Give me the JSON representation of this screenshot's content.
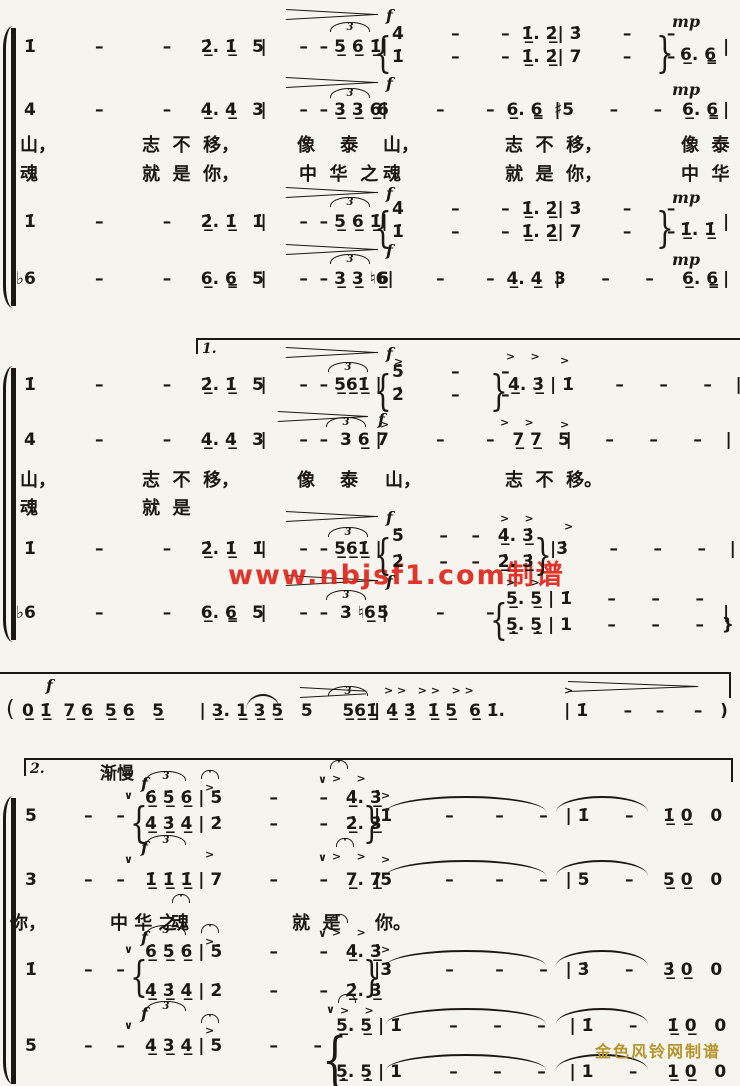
{
  "colors": {
    "paper": "#f6f4ee",
    "ink": "#1b1713",
    "watermark_red": "#e0241a",
    "watermark_gold": "#b5952c"
  },
  "watermark_red": {
    "text": "www.nbjsf1.com制谱"
  },
  "watermark_gold": {
    "text": "金色风铃网制谱"
  },
  "volta_labels": {
    "first": "1.",
    "second": "2."
  },
  "tempo_mark": "渐慢",
  "lyrics_lines": [
    "山， 志不移， 像泰山， 志不移， 像泰",
    "魂 就是你， 中华之魂 就是你， 中华",
    "山， 志不移， 像泰山， 志不移。",
    "魂 就是",
    "你， 中华之魂 就是你。"
  ],
  "segments": [
    {
      "n": "s1-sop-m1",
      "x": 24,
      "y": 37,
      "t": "1̇          –          –     2̲̇. 1̲̇    |"
    },
    {
      "n": "s1-sop-m2",
      "x": 252,
      "y": 37,
      "t": "5      –  – 5̲ 6̲ 1̲̇|"
    },
    {
      "n": "s1-sop-divisi-brace",
      "x": 374,
      "y": 28,
      "cls": "br",
      "t": "{"
    },
    {
      "n": "s1-sop-divisi-top",
      "x": 392,
      "y": 24,
      "t": "4̇        –       –  1̲̇. 2̲̇| 3̇       –      –"
    },
    {
      "n": "s1-sop-divisi-bottom",
      "x": 392,
      "y": 47,
      "t": "1̇        –       –  1̲̇. 2̲̇| 7       –      –"
    },
    {
      "n": "s1-sop-divisi-close",
      "x": 656,
      "y": 28,
      "cls": "br",
      "t": "}"
    },
    {
      "n": "s1-sop-m4-end",
      "x": 680,
      "y": 45,
      "t": "6̲. 6̳"
    },
    {
      "n": "s1-sop-barline-end",
      "x": 723,
      "y": 37,
      "t": "|"
    },
    {
      "n": "s1-alto-m1",
      "x": 24,
      "y": 100,
      "t": "4          –          –     4̲. 4̲    |"
    },
    {
      "n": "s1-alto-m2",
      "x": 252,
      "y": 100,
      "t": "3      –  – 3̲ 3̲ 6̲|"
    },
    {
      "n": "s1-alto-m3",
      "x": 377,
      "y": 100,
      "t": "6        –       –  6̲. 6̳  |"
    },
    {
      "n": "s1-alto-m4",
      "x": 554,
      "y": 100,
      "t": "♯5      –      –"
    },
    {
      "n": "s1-alto-m4-end",
      "x": 682,
      "y": 100,
      "t": "6̲. 6̳"
    },
    {
      "n": "s1-alto-barline-end",
      "x": 723,
      "y": 100,
      "t": "|"
    },
    {
      "n": "s1-lyric1-1",
      "cls": "lyr",
      "x": 20,
      "y": 131,
      "t": "山，"
    },
    {
      "n": "s1-lyric1-2",
      "cls": "lyr",
      "x": 142,
      "y": 131,
      "t": "志  不  移，"
    },
    {
      "n": "s1-lyric1-3",
      "cls": "lyr",
      "x": 297,
      "y": 131,
      "t": "像    泰"
    },
    {
      "n": "s1-lyric1-4",
      "cls": "lyr",
      "x": 383,
      "y": 131,
      "t": "山，"
    },
    {
      "n": "s1-lyric1-5",
      "cls": "lyr",
      "x": 505,
      "y": 131,
      "t": "志  不  移，"
    },
    {
      "n": "s1-lyric1-6",
      "cls": "lyr",
      "x": 681,
      "y": 131,
      "t": "像  泰"
    },
    {
      "n": "s1-lyric2-1",
      "cls": "lyr",
      "x": 20,
      "y": 160,
      "t": "魂"
    },
    {
      "n": "s1-lyric2-2",
      "cls": "lyr",
      "x": 142,
      "y": 160,
      "t": "就  是  你，"
    },
    {
      "n": "s1-lyric2-3",
      "cls": "lyr",
      "x": 299,
      "y": 160,
      "t": "中  华  之"
    },
    {
      "n": "s1-lyric2-4",
      "cls": "lyr",
      "x": 383,
      "y": 160,
      "t": "魂"
    },
    {
      "n": "s1-lyric2-5",
      "cls": "lyr",
      "x": 505,
      "y": 160,
      "t": "就  是  你，"
    },
    {
      "n": "s1-lyric2-6",
      "cls": "lyr",
      "x": 681,
      "y": 160,
      "t": "中  华"
    },
    {
      "n": "s1-ten-m1",
      "x": 24,
      "y": 212,
      "t": "1̇          –          –     2̲̇. 1̲̇    |"
    },
    {
      "n": "s1-ten-m2",
      "x": 252,
      "y": 212,
      "t": "1̇      –  – 5̲ 6̲ 1̲̇|"
    },
    {
      "n": "s1-ten-divisi-brace",
      "x": 374,
      "y": 203,
      "cls": "br",
      "t": "{"
    },
    {
      "n": "s1-ten-divisi-top",
      "x": 392,
      "y": 199,
      "t": "4̇        –       –  1̲̇. 2̲̇| 3̇       –      –"
    },
    {
      "n": "s1-ten-divisi-bottom",
      "x": 392,
      "y": 222,
      "t": "1̇        –       –  1̲̇. 2̲̇| 7       –      –"
    },
    {
      "n": "s1-ten-divisi-close",
      "x": 656,
      "y": 203,
      "cls": "br",
      "t": "}"
    },
    {
      "n": "s1-ten-m4-end",
      "x": 680,
      "y": 220,
      "t": "1̲̇. 1̲̇"
    },
    {
      "n": "s1-ten-barline-end",
      "x": 723,
      "y": 212,
      "t": "|"
    },
    {
      "n": "s1-bass-m1",
      "x": 16,
      "y": 269,
      "t": "♭6          –          –     6̲. 6̳    |"
    },
    {
      "n": "s1-bass-m2",
      "x": 252,
      "y": 269,
      "t": "5      –  – 3̲ 3̲ ♮6̲|"
    },
    {
      "n": "s1-bass-m3",
      "x": 377,
      "y": 269,
      "t": "6        –       –  4̲. 4̲  |"
    },
    {
      "n": "s1-bass-m4",
      "x": 554,
      "y": 269,
      "t": "3      –      –"
    },
    {
      "n": "s1-bass-m4-end",
      "x": 682,
      "y": 269,
      "t": "6̲. 6̳"
    },
    {
      "n": "s1-bass-barline-end",
      "x": 723,
      "y": 269,
      "t": "|"
    },
    {
      "n": "triplet-mark",
      "cls": "tri",
      "x": 330,
      "y": 22,
      "t": "3"
    },
    {
      "n": "triplet-mark",
      "cls": "tri",
      "x": 330,
      "y": 88,
      "t": "3"
    },
    {
      "n": "triplet-mark",
      "cls": "tri",
      "x": 330,
      "y": 197,
      "t": "3"
    },
    {
      "n": "triplet-mark",
      "cls": "tri",
      "x": 330,
      "y": 254,
      "t": "3"
    },
    {
      "n": "dynamic-f",
      "cls": "dyn",
      "x": 386,
      "y": 6,
      "t": "f"
    },
    {
      "n": "dynamic-f",
      "cls": "dyn",
      "x": 386,
      "y": 74,
      "t": "f"
    },
    {
      "n": "dynamic-f",
      "cls": "dyn",
      "x": 386,
      "y": 184,
      "t": "f"
    },
    {
      "n": "dynamic-f",
      "cls": "dyn",
      "x": 386,
      "y": 241,
      "t": "f"
    },
    {
      "n": "dynamic-mp",
      "cls": "dyn",
      "x": 672,
      "y": 12,
      "t": "mp"
    },
    {
      "n": "dynamic-mp",
      "cls": "dyn",
      "x": 672,
      "y": 80,
      "t": "mp"
    },
    {
      "n": "dynamic-mp",
      "cls": "dyn",
      "x": 672,
      "y": 188,
      "t": "mp"
    },
    {
      "n": "dynamic-mp",
      "cls": "dyn",
      "x": 672,
      "y": 250,
      "t": "mp"
    },
    {
      "n": "volta1-label",
      "cls": "volta",
      "x": 202,
      "y": 341,
      "t": "1."
    },
    {
      "n": "s2-sop-m1",
      "x": 24,
      "y": 375,
      "t": "1̇          –          –     2̲̇. 1̲̇    |"
    },
    {
      "n": "s2-sop-m2",
      "x": 252,
      "y": 375,
      "t": "5      –  – 5̲6̲1̲̇ |"
    },
    {
      "n": "s2-sop-divisi-brace",
      "x": 374,
      "y": 366,
      "cls": "br",
      "t": "{"
    },
    {
      "n": "s2-sop-divisi-top",
      "x": 392,
      "y": 362,
      "t": "5̇        –       –"
    },
    {
      "n": "s2-sop-divisi-bottom",
      "x": 392,
      "y": 385,
      "t": "2̇        –       –"
    },
    {
      "n": "s2-sop-divisi-close",
      "x": 490,
      "y": 366,
      "cls": "br",
      "t": "}"
    },
    {
      "n": "s2-sop-m3b",
      "x": 508,
      "y": 375,
      "t": "4̲̇. 3̲̇ | 1̇       –      –      –    |"
    },
    {
      "n": "s2-alto-m1",
      "x": 24,
      "y": 430,
      "t": "4          –          –     4̲. 4̲    |"
    },
    {
      "n": "s2-alto-m2",
      "x": 252,
      "y": 430,
      "t": "3      –  –  3 6̲ |"
    },
    {
      "n": "s2-alto-m3",
      "x": 377,
      "y": 430,
      "t": "7        –       –   7̲ 7̲    |"
    },
    {
      "n": "s2-alto-m4",
      "x": 558,
      "y": 430,
      "t": "5      –      –      –    |"
    },
    {
      "n": "s2-lyric1-1",
      "cls": "lyr",
      "x": 20,
      "y": 466,
      "t": "山，"
    },
    {
      "n": "s2-lyric1-2",
      "cls": "lyr",
      "x": 142,
      "y": 466,
      "t": "志  不  移，"
    },
    {
      "n": "s2-lyric1-3",
      "cls": "lyr",
      "x": 297,
      "y": 466,
      "t": "像    泰"
    },
    {
      "n": "s2-lyric1-4",
      "cls": "lyr",
      "x": 385,
      "y": 466,
      "t": "山，"
    },
    {
      "n": "s2-lyric1-5",
      "cls": "lyr",
      "x": 505,
      "y": 466,
      "t": "志  不  移。"
    },
    {
      "n": "s2-lyric2-1",
      "cls": "lyr",
      "x": 20,
      "y": 494,
      "t": "魂"
    },
    {
      "n": "s2-lyric2-2",
      "cls": "lyr",
      "x": 142,
      "y": 494,
      "t": "就  是"
    },
    {
      "n": "s2-ten-m1",
      "x": 24,
      "y": 539,
      "t": "1̇          –          –     2̲̇. 1̲̇    |"
    },
    {
      "n": "s2-ten-m2",
      "x": 252,
      "y": 539,
      "t": "1̇      –  – 5̲6̲1̲̇ |"
    },
    {
      "n": "s2-ten-divisi-brace",
      "x": 374,
      "y": 530,
      "cls": "br",
      "t": "{"
    },
    {
      "n": "s2-ten-divisi-top",
      "x": 392,
      "y": 526,
      "t": "5̇      –    –   4̲̇. 3̲̇"
    },
    {
      "n": "s2-ten-divisi-bottom",
      "x": 392,
      "y": 552,
      "t": "2̇      –    –   2̲̇. 3̲̇"
    },
    {
      "n": "s2-ten-divisi-close",
      "x": 534,
      "y": 530,
      "cls": "br",
      "t": "}"
    },
    {
      "n": "s2-ten-m4",
      "x": 550,
      "y": 539,
      "t": "|3̇       –      –      –    |"
    },
    {
      "n": "s2-bass-m1",
      "x": 16,
      "y": 603,
      "t": "♭6          –          –     6̲. 6̳    |"
    },
    {
      "n": "s2-bass-m2",
      "x": 252,
      "y": 603,
      "t": "5      –  –  3 ♮6̲ |"
    },
    {
      "n": "s2-bass-m3",
      "x": 377,
      "y": 603,
      "t": "5        –       –"
    },
    {
      "n": "s2-bass-divisi-brace",
      "x": 490,
      "y": 595,
      "cls": "br",
      "t": "{"
    },
    {
      "n": "s2-bass-divisi-top",
      "x": 506,
      "y": 589,
      "t": "5̲. 5̲ | 1̇      –      –      –"
    },
    {
      "n": "s2-bass-divisi-bottom",
      "x": 506,
      "y": 615,
      "t": "5̲̣. 5̲̣ | 1      –      –      –   }"
    },
    {
      "n": "s2-bass-barline-end",
      "x": 723,
      "y": 603,
      "t": "|"
    },
    {
      "n": "dynamic-f",
      "cls": "dyn",
      "x": 386,
      "y": 344,
      "t": "f"
    },
    {
      "n": "dynamic-f",
      "cls": "dyn",
      "x": 378,
      "y": 410,
      "t": "f"
    },
    {
      "n": "dynamic-f",
      "cls": "dyn",
      "x": 386,
      "y": 508,
      "t": "f"
    },
    {
      "n": "dynamic-f",
      "cls": "dyn",
      "x": 386,
      "y": 572,
      "t": "f"
    },
    {
      "n": "triplet-mark",
      "cls": "tri",
      "x": 328,
      "y": 362,
      "t": "3"
    },
    {
      "n": "triplet-mark",
      "cls": "tri",
      "x": 326,
      "y": 417,
      "t": "3"
    },
    {
      "n": "triplet-mark",
      "cls": "tri",
      "x": 328,
      "y": 527,
      "t": "3"
    },
    {
      "n": "triplet-mark",
      "cls": "tri",
      "x": 326,
      "y": 590,
      "t": "3"
    },
    {
      "n": "accent-mark",
      "cls": "mark",
      "x": 394,
      "y": 355,
      "t": ">"
    },
    {
      "n": "accent-mark",
      "cls": "mark",
      "x": 506,
      "y": 350,
      "t": ">    >"
    },
    {
      "n": "accent-mark",
      "cls": "mark",
      "x": 560,
      "y": 354,
      "t": ">"
    },
    {
      "n": "accent-mark",
      "cls": "mark",
      "x": 380,
      "y": 418,
      "t": ">"
    },
    {
      "n": "accent-mark",
      "cls": "mark",
      "x": 500,
      "y": 416,
      "t": ">    >"
    },
    {
      "n": "accent-mark",
      "cls": "mark",
      "x": 560,
      "y": 418,
      "t": ">"
    },
    {
      "n": "accent-mark",
      "cls": "mark",
      "x": 500,
      "y": 512,
      "t": ">    >"
    },
    {
      "n": "accent-mark",
      "cls": "mark",
      "x": 564,
      "y": 520,
      "t": ">"
    },
    {
      "n": "accent-mark",
      "cls": "mark",
      "x": 506,
      "y": 576,
      "t": ">    >"
    },
    {
      "n": "dynamic-f",
      "cls": "dyn",
      "x": 46,
      "y": 676,
      "t": "f"
    },
    {
      "n": "interlude-open-paren",
      "cls": "paren",
      "x": 6,
      "y": 697,
      "t": "("
    },
    {
      "n": "interlude-m1-m2",
      "x": 22,
      "y": 701,
      "t": "0̲ 1̲̇  7̲ 6̲  5̲ 6̲   5̲      | 3̲. 1̲ 3̲ 5̲   5     5̲6̲1̲̇"
    },
    {
      "n": "interlude-m3-m4",
      "x": 374,
      "y": 701,
      "t": "| 4̲̇ 3̲̇  1̲̇ 5̲  6̲ 1̇.          | 1̇      –    –     –   )  :‖"
    },
    {
      "n": "triplet-mark",
      "cls": "tri",
      "x": 328,
      "y": 686,
      "t": "3"
    },
    {
      "n": "accent-mark",
      "cls": "mark",
      "x": 384,
      "y": 684,
      "t": "> >   > >   > >"
    },
    {
      "n": "accent-mark",
      "cls": "mark",
      "x": 564,
      "y": 684,
      "t": ">"
    },
    {
      "n": "volta2-label",
      "cls": "volta",
      "x": 30,
      "y": 761,
      "t": "2."
    },
    {
      "n": "tempo-mark",
      "cls": "tempo",
      "x": 100,
      "y": 759,
      "t": "渐慢"
    },
    {
      "n": "s3-sop-m1",
      "x": 25,
      "y": 806,
      "t": "5        –    –"
    },
    {
      "n": "breath-mark",
      "cls": "mark",
      "x": 124,
      "y": 789,
      "t": "∨"
    },
    {
      "n": "dynamic-f",
      "cls": "dyn",
      "x": 141,
      "y": 774,
      "t": "f"
    },
    {
      "n": "triplet-mark",
      "cls": "tri",
      "x": 146,
      "y": 771,
      "t": "3"
    },
    {
      "n": "s3-sop-divisi-brace",
      "x": 130,
      "y": 798,
      "cls": "br",
      "t": "{"
    },
    {
      "n": "s3-sop-divisi-top",
      "x": 145,
      "y": 788,
      "t": "6̲̇ 5̲̇ 6̲̇ | 5̇        –       –   4̲̇. 3̲̇"
    },
    {
      "n": "s3-sop-divisi-bottom",
      "x": 145,
      "y": 814,
      "t": "4̲̇ 3̲̇ 4̲̇ | 2̇        –       –   2̲̇. 3̲̇"
    },
    {
      "n": "s3-sop-divisi-close",
      "x": 363,
      "y": 798,
      "cls": "br",
      "t": "}"
    },
    {
      "n": "s3-sop-m3-m4",
      "x": 374,
      "y": 806,
      "t": "|1̇         –       –      –   | 1̇      –     1̲̇ 0̲   0      ‖"
    },
    {
      "n": "fermata-mark",
      "cls": "ferm",
      "x": 201,
      "y": 770,
      "t": "·"
    },
    {
      "n": "accent-mark",
      "cls": "mark",
      "x": 205,
      "y": 781,
      "t": ">"
    },
    {
      "n": "fermata-mark",
      "cls": "ferm",
      "x": 330,
      "y": 760,
      "t": "·"
    },
    {
      "n": "breath-mark",
      "cls": "mark",
      "x": 318,
      "y": 773,
      "t": "∨"
    },
    {
      "n": "accent-mark",
      "cls": "mark",
      "x": 332,
      "y": 772,
      "t": ">    >"
    },
    {
      "n": "accent-mark",
      "cls": "mark",
      "x": 381,
      "y": 789,
      "t": ">"
    },
    {
      "n": "s3-alto-m1",
      "x": 25,
      "y": 870,
      "t": "3        –    –"
    },
    {
      "n": "breath-mark",
      "cls": "mark",
      "x": 124,
      "y": 853,
      "t": "∨"
    },
    {
      "n": "dynamic-f",
      "cls": "dyn",
      "x": 141,
      "y": 838,
      "t": "f"
    },
    {
      "n": "triplet-mark",
      "cls": "tri",
      "x": 146,
      "y": 835,
      "t": "3"
    },
    {
      "n": "s3-alto-m2",
      "x": 145,
      "y": 870,
      "t": "1̲̇ 1̲̇ 1̲̇ | 7        –       –   7̲. 7̲"
    },
    {
      "n": "s3-alto-m3-m4",
      "x": 374,
      "y": 870,
      "t": "|5         –       –      –   | 5      –     5̲ 0̲   0      ‖"
    },
    {
      "n": "accent-mark",
      "cls": "mark",
      "x": 205,
      "y": 848,
      "t": ">"
    },
    {
      "n": "fermata-mark",
      "cls": "ferm",
      "x": 336,
      "y": 838,
      "t": "·"
    },
    {
      "n": "breath-mark",
      "cls": "mark",
      "x": 318,
      "y": 851,
      "t": "∨"
    },
    {
      "n": "accent-mark",
      "cls": "mark",
      "x": 332,
      "y": 850,
      "t": ">    >"
    },
    {
      "n": "accent-mark",
      "cls": "mark",
      "x": 381,
      "y": 853,
      "t": ">"
    },
    {
      "n": "s3-lyric-1",
      "cls": "lyr",
      "x": 10,
      "y": 909,
      "t": "你，"
    },
    {
      "n": "s3-lyric-2",
      "cls": "lyr",
      "x": 110,
      "y": 909,
      "t": "中 华 之"
    },
    {
      "n": "s3-lyric-3",
      "cls": "lyr",
      "x": 171,
      "y": 909,
      "t": "魂"
    },
    {
      "n": "s3-lyric-4",
      "cls": "lyr",
      "x": 292,
      "y": 909,
      "t": "就  是"
    },
    {
      "n": "s3-lyric-5",
      "cls": "lyr",
      "x": 375,
      "y": 909,
      "t": "你。"
    },
    {
      "n": "fermata-mark",
      "cls": "ferm",
      "x": 172,
      "y": 894,
      "t": "·"
    },
    {
      "n": "s3-ten-m1",
      "x": 25,
      "y": 960,
      "t": "1̇        –    –"
    },
    {
      "n": "breath-mark",
      "cls": "mark",
      "x": 124,
      "y": 943,
      "t": "∨"
    },
    {
      "n": "dynamic-f",
      "cls": "dyn",
      "x": 141,
      "y": 928,
      "t": "f"
    },
    {
      "n": "triplet-mark",
      "cls": "tri",
      "x": 146,
      "y": 925,
      "t": "3"
    },
    {
      "n": "s3-ten-divisi-brace",
      "x": 130,
      "y": 952,
      "cls": "br",
      "t": "{"
    },
    {
      "n": "s3-ten-divisi-top",
      "x": 145,
      "y": 942,
      "t": "6̲̇ 5̲̇ 6̲̇ | 5̇        –       –   4̲̇. 3̲̇"
    },
    {
      "n": "s3-ten-divisi-bottom",
      "x": 145,
      "y": 981,
      "t": "4̲̇ 3̲̇ 4̲̇ | 2̇        –       –   2̲̇. 3̲̇"
    },
    {
      "n": "s3-ten-divisi-close",
      "x": 363,
      "y": 952,
      "cls": "br",
      "t": "}"
    },
    {
      "n": "s3-ten-m3-m4",
      "x": 374,
      "y": 960,
      "t": "|3̇         –       –      –   | 3̇      –     3̲̇ 0̲   0      ‖"
    },
    {
      "n": "fermata-mark",
      "cls": "ferm",
      "x": 201,
      "y": 924,
      "t": "·"
    },
    {
      "n": "accent-mark",
      "cls": "mark",
      "x": 205,
      "y": 935,
      "t": ">"
    },
    {
      "n": "fermata-mark",
      "cls": "ferm",
      "x": 330,
      "y": 914,
      "t": "·"
    },
    {
      "n": "breath-mark",
      "cls": "mark",
      "x": 318,
      "y": 927,
      "t": "∨"
    },
    {
      "n": "accent-mark",
      "cls": "mark",
      "x": 332,
      "y": 926,
      "t": ">    >"
    },
    {
      "n": "accent-mark",
      "cls": "mark",
      "x": 381,
      "y": 943,
      "t": ">"
    },
    {
      "n": "s3-bass-m1",
      "x": 25,
      "y": 1036,
      "t": "5        –    –"
    },
    {
      "n": "breath-mark",
      "cls": "mark",
      "x": 124,
      "y": 1019,
      "t": "∨"
    },
    {
      "n": "dynamic-f",
      "cls": "dyn",
      "x": 141,
      "y": 1004,
      "t": "f"
    },
    {
      "n": "triplet-mark",
      "cls": "tri",
      "x": 146,
      "y": 1001,
      "t": "3"
    },
    {
      "n": "s3-bass-m2",
      "x": 145,
      "y": 1036,
      "t": "4̲ 3̲ 4̲ | 5        –      –"
    },
    {
      "n": "s3-bass-divisi-brace",
      "x": 322,
      "y": 1026,
      "cls": "br",
      "s": 40,
      "t": "{"
    },
    {
      "n": "s3-bass-divisi-top",
      "x": 336,
      "y": 1016,
      "t": "5̲. 5̲ | 1̇        –      –      –    | 1̇      –     1̲̇ 0̲   0     ‖"
    },
    {
      "n": "s3-bass-divisi-bottom",
      "x": 336,
      "y": 1062,
      "t": "5̲̣. 5̲̣ | 1        –      –      –    | 1      –     1̲ 0̲   0     ‖"
    },
    {
      "n": "fermata-mark",
      "cls": "ferm",
      "x": 201,
      "y": 1014,
      "t": "·"
    },
    {
      "n": "accent-mark",
      "cls": "mark",
      "x": 205,
      "y": 1024,
      "t": ">"
    },
    {
      "n": "fermata-mark",
      "cls": "ferm",
      "x": 338,
      "y": 994,
      "t": "·"
    },
    {
      "n": "breath-mark",
      "cls": "mark",
      "x": 326,
      "y": 1003,
      "t": "∨"
    },
    {
      "n": "accent-mark",
      "cls": "mark",
      "x": 340,
      "y": 1004,
      "t": ">    >"
    }
  ]
}
